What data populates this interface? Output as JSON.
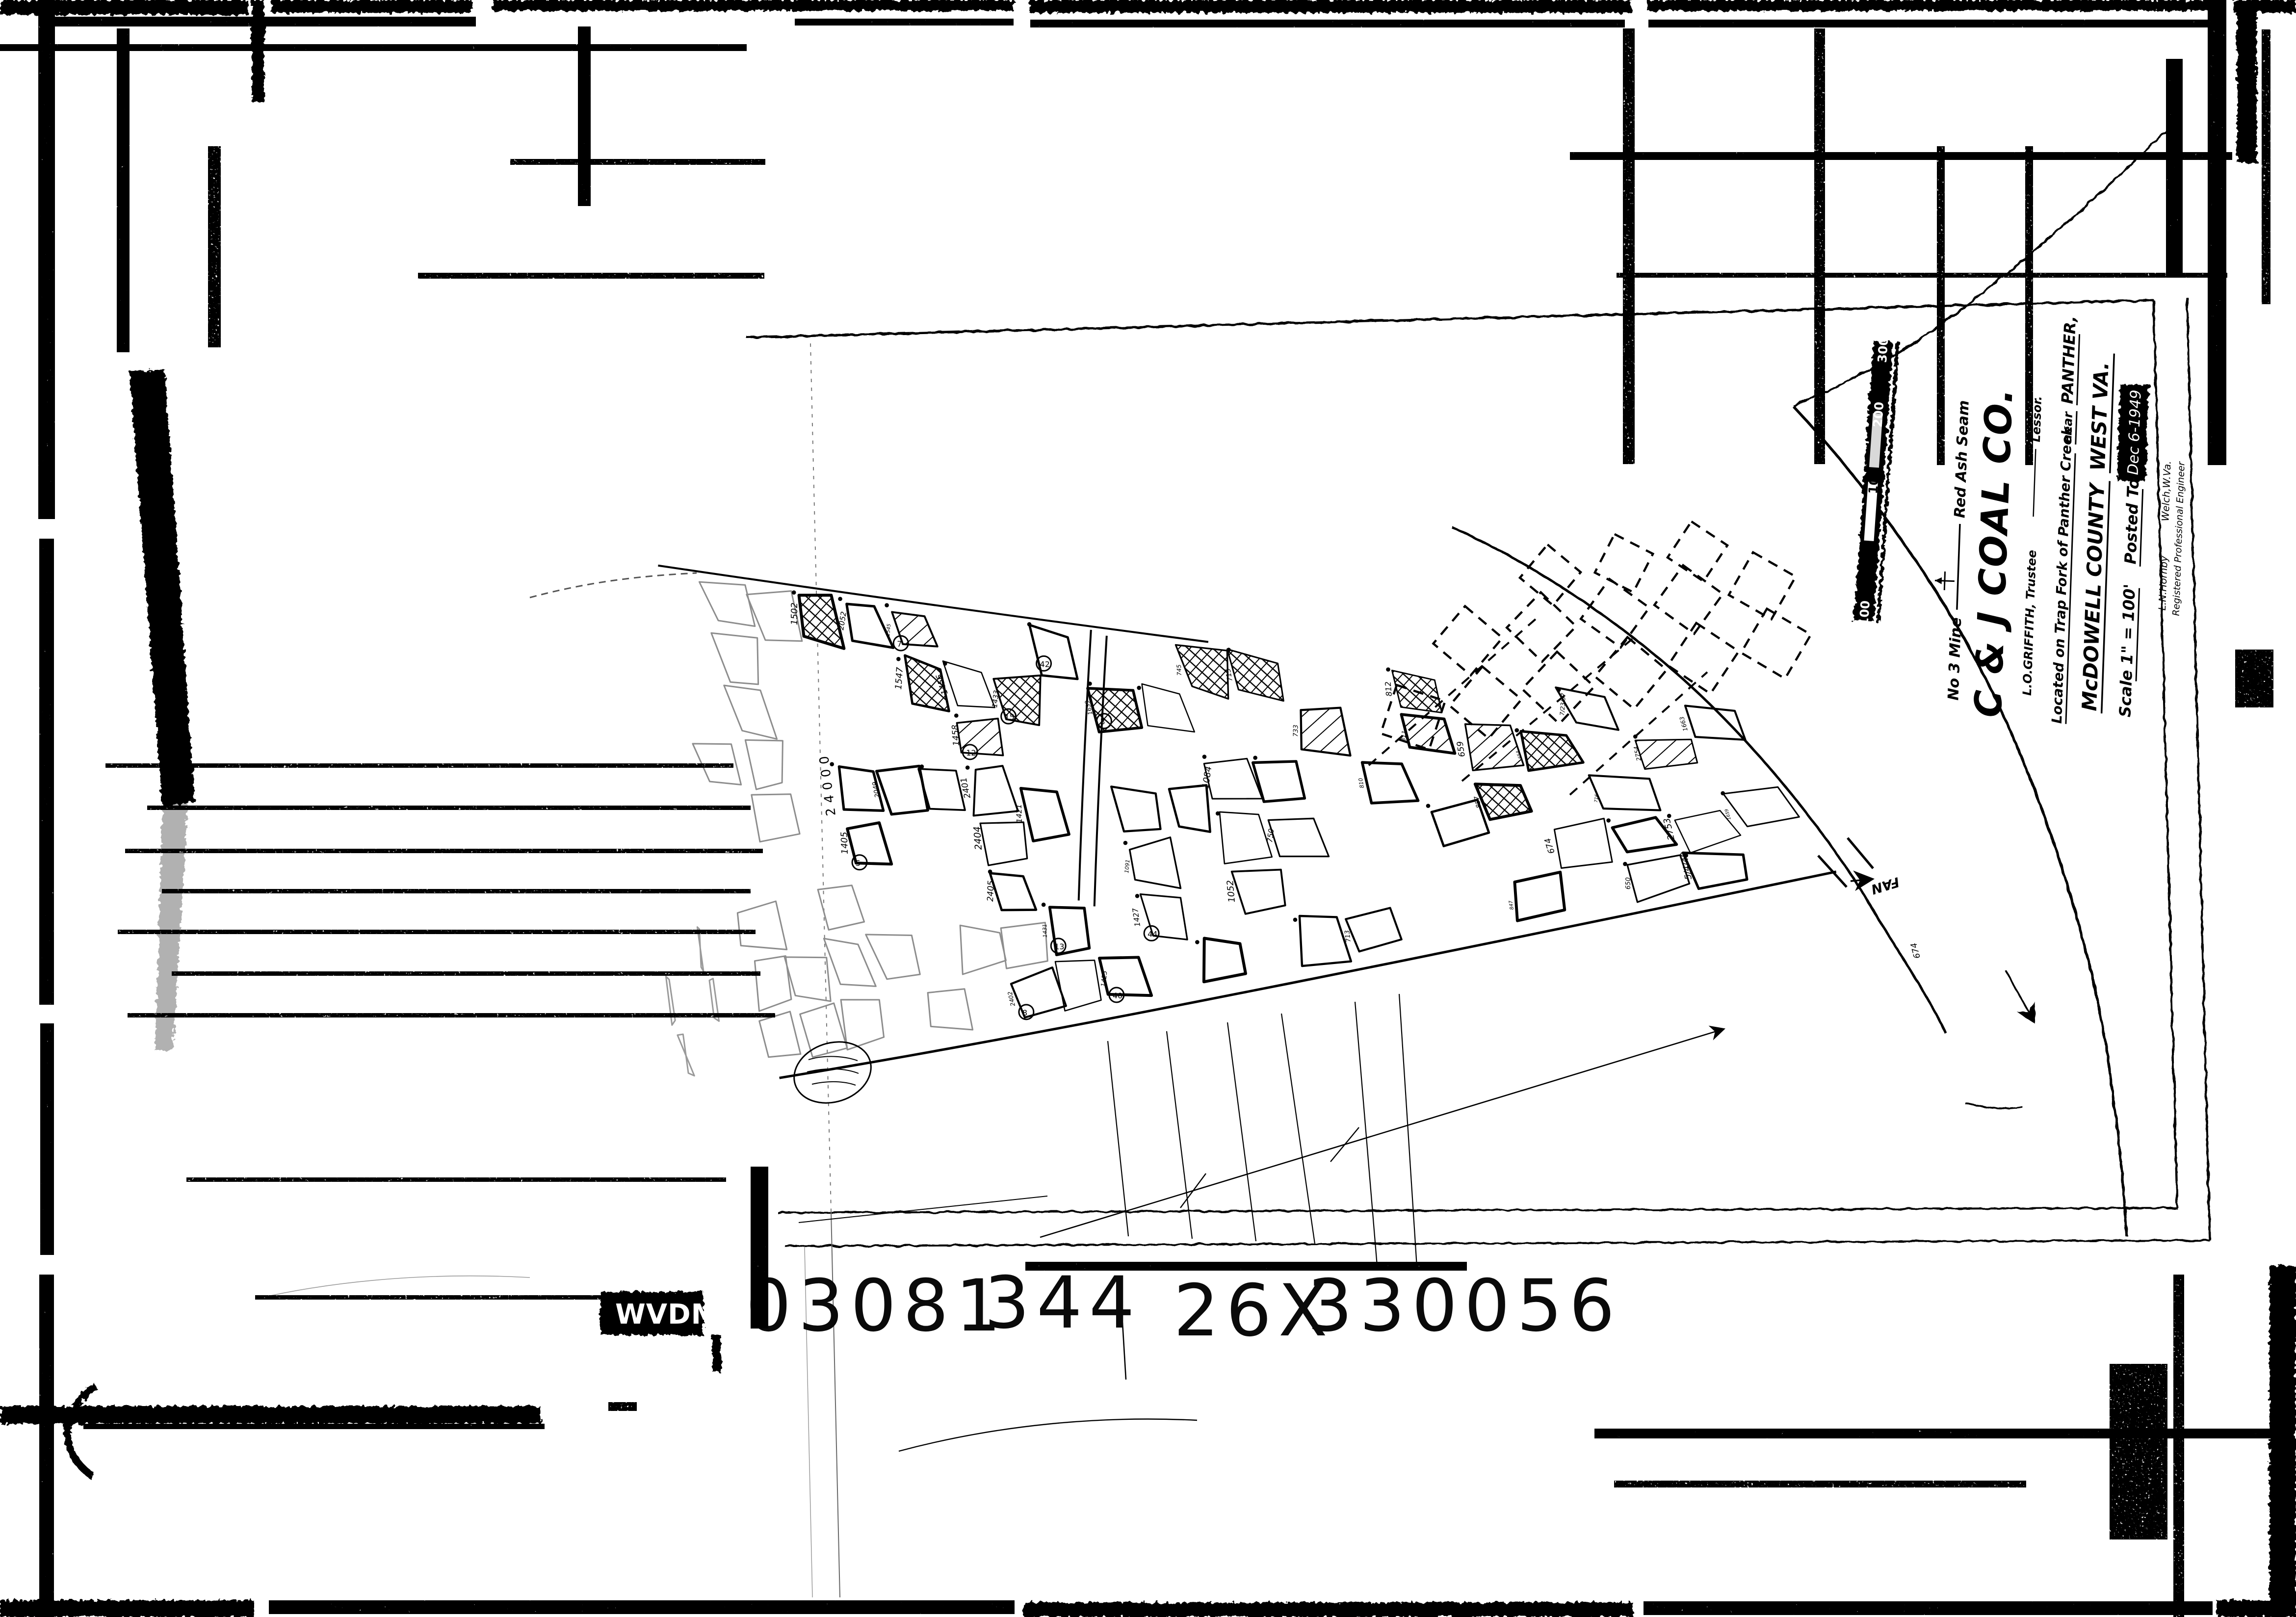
{
  "film_label": {
    "agency": "WVDM",
    "groups": [
      "03081",
      "344",
      "26X",
      "330056"
    ]
  },
  "title_block": {
    "mine_line": "No 3 Mine",
    "seam_line": "Red Ash Seam",
    "company": "C & J COAL CO.",
    "lessor_name": "L.O.GRIFFITH, Trustee",
    "lessor_word": "Lessor.",
    "located_line": "Located on Trap Fork of Panther Creek",
    "near_word": "near",
    "town": "PANTHER,",
    "county": "McDOWELL COUNTY",
    "state": "WEST VA.",
    "scale_label": "Scale 1\" = 100'",
    "posted_label": "Posted To",
    "posted_date": "Dec 6-1949",
    "engineer_name": "L.N.Hornby",
    "engineer_town": "Welch,W.Va.",
    "engineer_title": "Registered Professional Engineer"
  },
  "scale_bar": {
    "labels": [
      "100",
      "0",
      "100",
      "200",
      "300"
    ]
  },
  "map": {
    "fan_label": "FAN",
    "coordinate_label": "24000",
    "creek_elevation": "674",
    "elevations": [
      "1405",
      "1502",
      "2049",
      "2052",
      "1547",
      "1545",
      "2402",
      "2405",
      "2404",
      "2401",
      "1458",
      "1456",
      "1431",
      "1421",
      "1433",
      "1425",
      "1427",
      "1091",
      "1639",
      "1052",
      "1084",
      "745",
      "750",
      "715",
      "713",
      "733",
      "810",
      "811",
      "812",
      "847",
      "857",
      "659",
      "674",
      "654",
      "650",
      "716",
      "7/23/57",
      "5/4/48",
      "2753",
      "2754",
      "1659",
      "1663",
      "1669",
      "5561",
      "6531",
      "1945",
      "1450",
      "1443"
    ],
    "stations": [
      "5",
      "7",
      "8",
      "12",
      "13",
      "15",
      "40",
      "42",
      "44",
      "3"
    ]
  },
  "colors": {
    "ink": "#000000",
    "faded_ink": "#8d8d8d",
    "paper": "#ffffff"
  }
}
